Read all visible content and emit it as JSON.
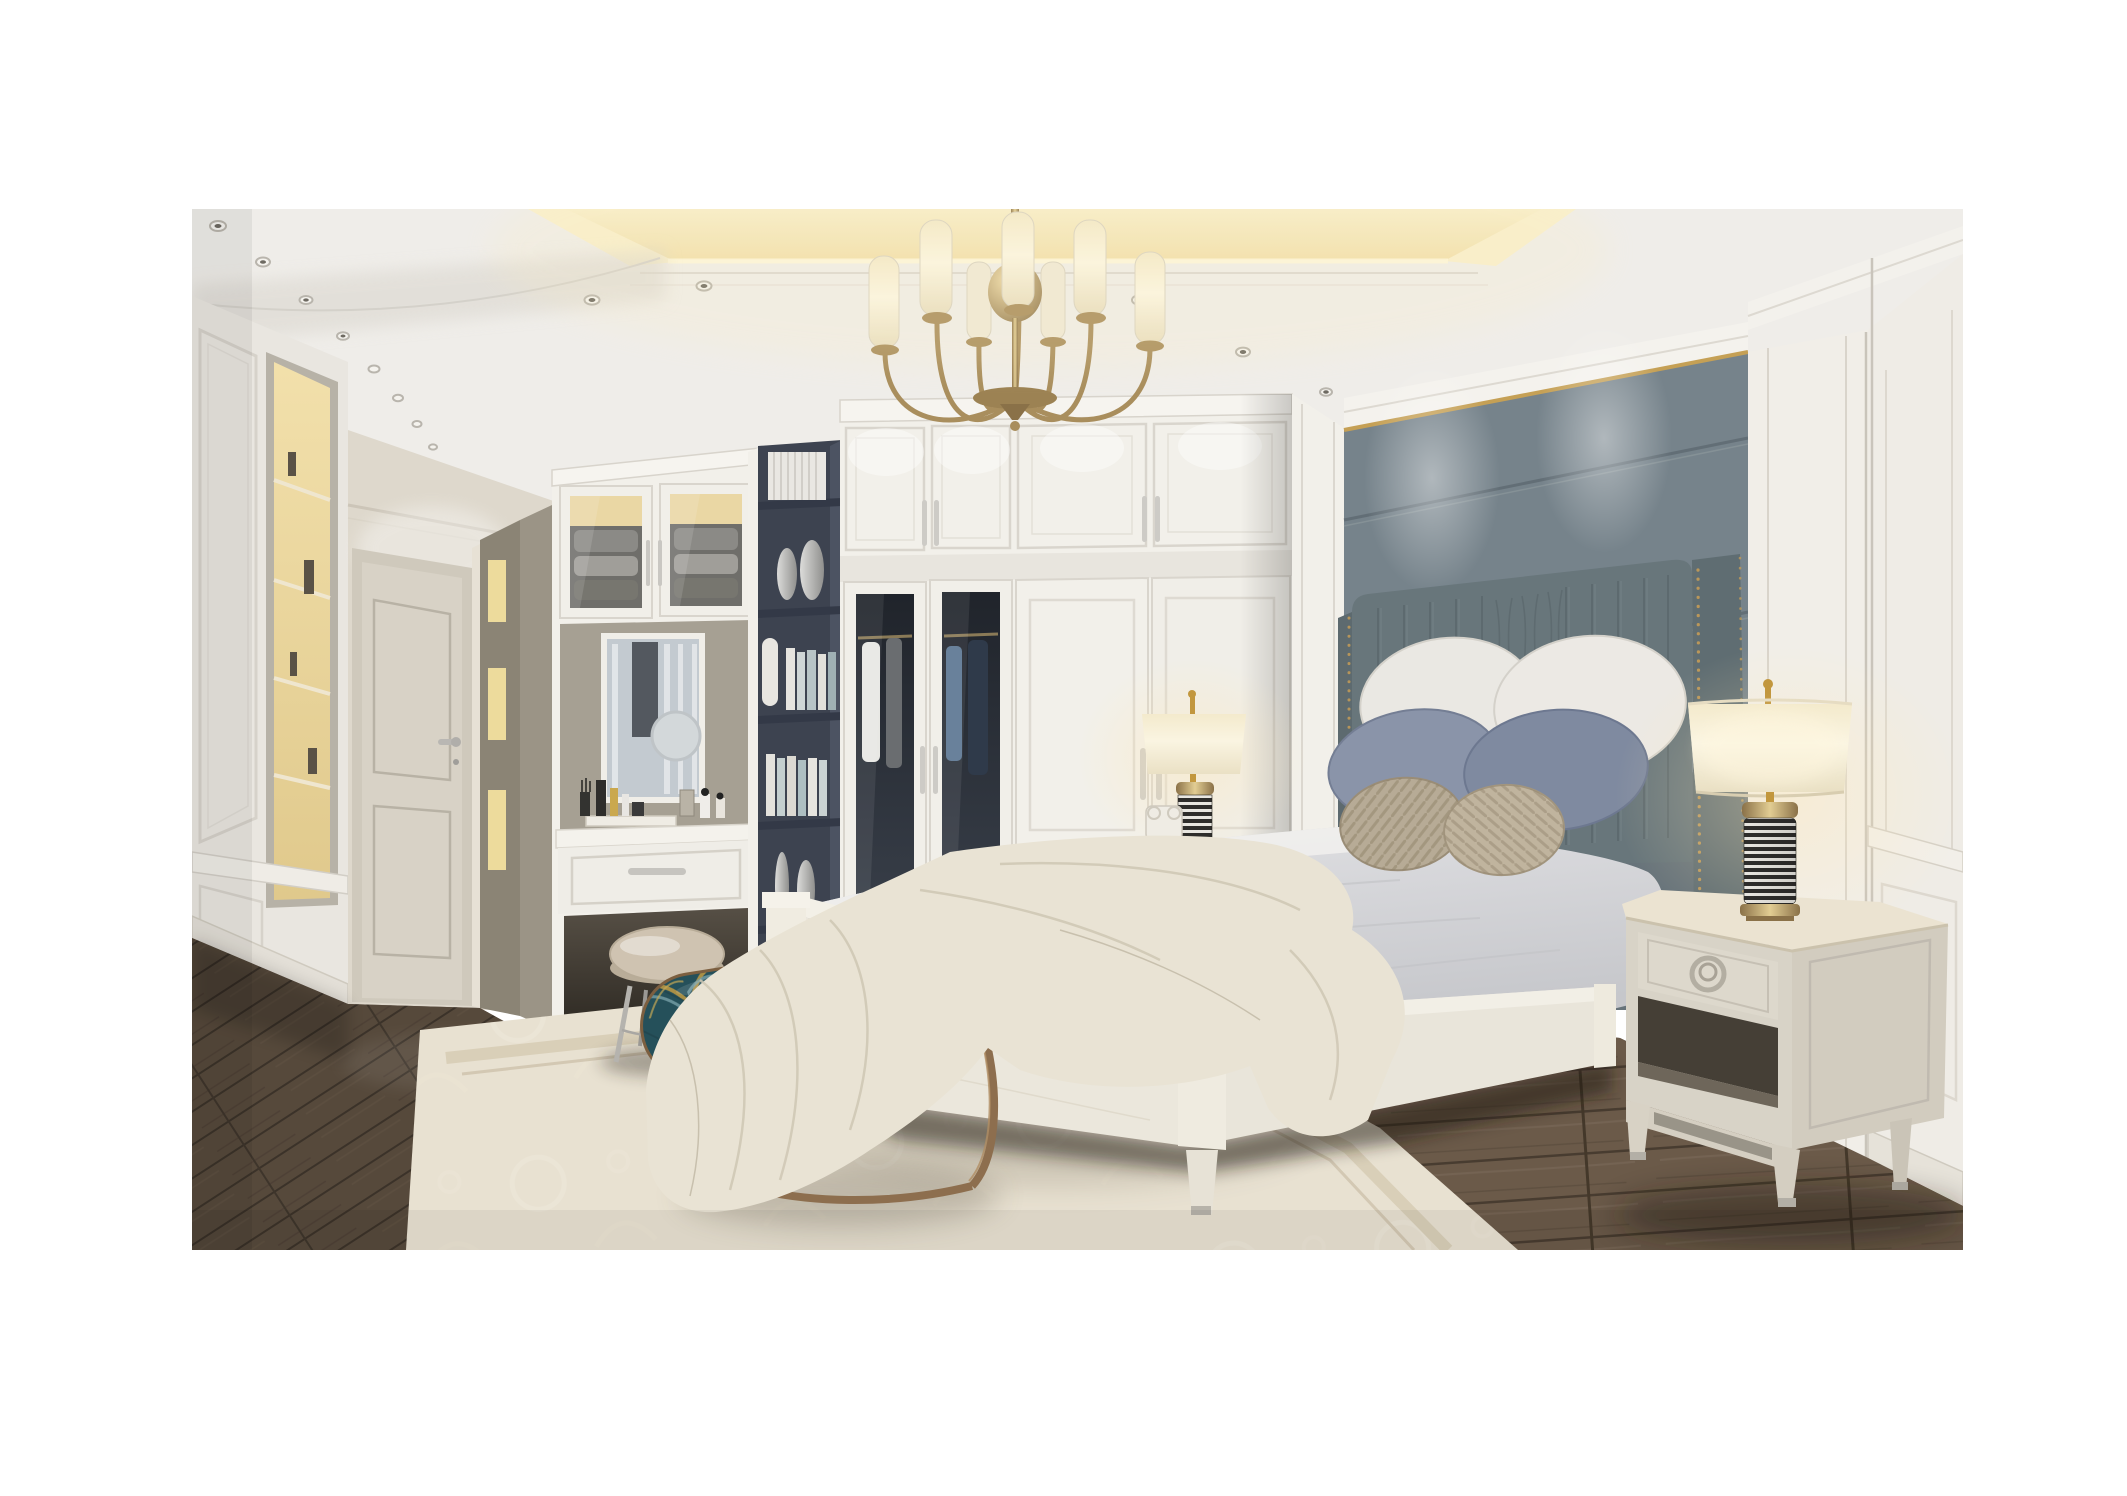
{
  "image": {
    "kind": "interior-render",
    "room": "luxury bedroom with dressing hallway",
    "style": "light american classic, white millwork with brass accents"
  },
  "palette": {
    "ceiling": "#efede9",
    "cove_glow": "#f5e8c2",
    "wall_white": "#eae7e1",
    "wardrobe_white": "#f2f0ea",
    "accent_wall": "#76838b",
    "gold_trim": "#c5a055",
    "headboard": "#68767b",
    "pillow_white": "#eae8e3",
    "pillow_blue": "#8a94a9",
    "pillow_taupe": "#b7ab96",
    "sheet": "#efeeec",
    "throw": "#e9e3d4",
    "bed_frame": "#ebe7dc",
    "nightstand": "#d8d3c7",
    "lamp_shade": "#f6eed6",
    "brass": "#c2973e",
    "bench_teal": "#25505a",
    "bronze": "#8d6e4e",
    "stool": "#cfc3b1",
    "bookshelf": "#3d4350",
    "door": "#d8d2c6",
    "rug": "#e8e1d1",
    "floor_mid": "#5e5043"
  },
  "scene": {
    "objects": [
      {
        "name": "chandelier",
        "desc": "brass 8-arm chandelier, white cylinder glass shades, center sphere"
      },
      {
        "name": "tray-ceiling",
        "desc": "recessed tray ceiling with warm cove lighting and recessed downlights"
      },
      {
        "name": "hallway",
        "desc": "paneled corridor with lit display niches and a paneled door"
      },
      {
        "name": "vanity",
        "desc": "built-in dressing table with mirror, cosmetics, drawer and glass upper cabinets"
      },
      {
        "name": "bookshelf",
        "desc": "dark slate open shelving column with books, magazines and silver vases"
      },
      {
        "name": "wardrobe",
        "desc": "white built-in wardrobe, two smoked-glass doors with hanging clothes"
      },
      {
        "name": "accent-wall",
        "desc": "gray-blue upholstered headboard wall with gold trim"
      },
      {
        "name": "bed",
        "desc": "white wood bed, channel-tufted headboard with nailhead trim, gray duvet, cream throw"
      },
      {
        "name": "pillows",
        "desc": "two white, two slate-blue, two striped taupe pillows"
      },
      {
        "name": "nightstands",
        "desc": "two cream one-drawer nightstands with ring pulls"
      },
      {
        "name": "lamps",
        "desc": "two table lamps, cream drum shade, brass caps, black-white striped body"
      },
      {
        "name": "bench",
        "desc": "oval bench with teal-gold fan-pattern fabric on bronze ring base"
      },
      {
        "name": "stool",
        "desc": "round leather vanity stool with silver legs"
      },
      {
        "name": "rug",
        "desc": "cream tone-on-tone patterned rug with border"
      },
      {
        "name": "floor",
        "desc": "dark walnut plank floor"
      }
    ]
  }
}
